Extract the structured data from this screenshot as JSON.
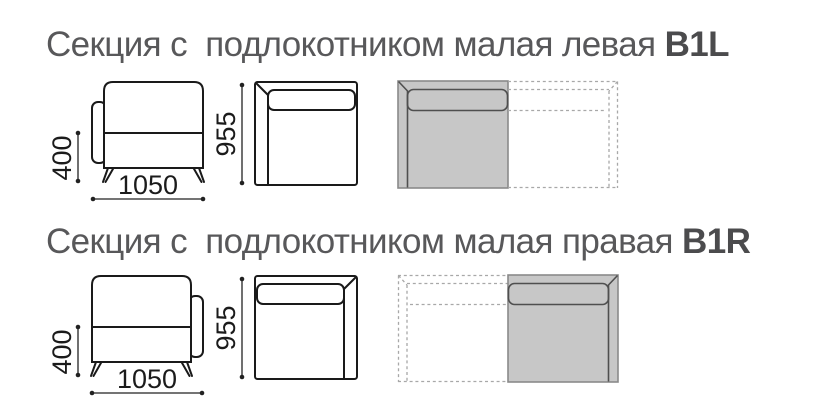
{
  "rows": [
    {
      "title": "Секция с  подлокотником малая левая ",
      "code": "B1L",
      "dims": {
        "height": "400",
        "width": "1050",
        "depth": "955"
      }
    },
    {
      "title": "Секция с  подлокотником малая правая ",
      "code": "B1R",
      "dims": {
        "height": "400",
        "width": "1050",
        "depth": "955"
      }
    }
  ],
  "colors": {
    "title_text": "#58585a",
    "drawing_line": "#1a1a1a",
    "section_fill": "#c7c7c7",
    "section_border": "#8a8a8a",
    "section_inner_line": "#4f4f4f",
    "ghost_dash": "#a8a8a8"
  }
}
